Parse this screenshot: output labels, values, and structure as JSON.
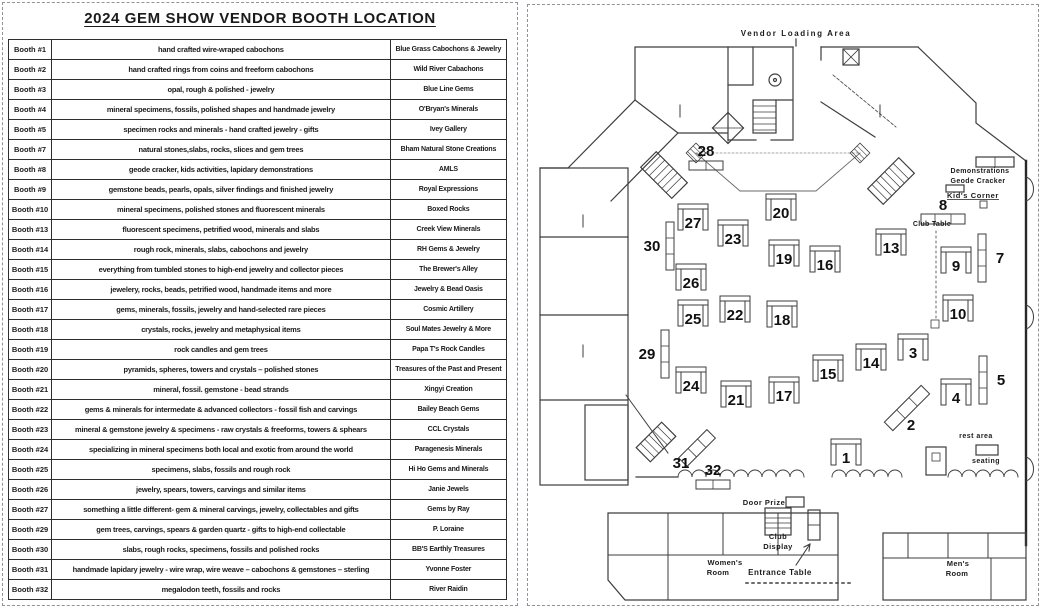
{
  "title": "2024 GEM SHOW VENDOR  BOOTH  LOCATION",
  "table": {
    "rows": [
      {
        "booth": "Booth #1",
        "description": "hand crafted wire-wraped cabochons",
        "vendor": "Blue Grass Cabochons & Jewelry"
      },
      {
        "booth": "Booth #2",
        "description": "hand crafted rings from coins and freeform cabochons",
        "vendor": "Wild River Cabachons"
      },
      {
        "booth": "Booth #3",
        "description": "opal, rough & polished - jewelry",
        "vendor": "Blue Line Gems"
      },
      {
        "booth": "Booth #4",
        "description": "mineral specimens, fossils, polished shapes and handmade jewelry",
        "vendor": "O'Bryan's Minerals"
      },
      {
        "booth": "Booth #5",
        "description": "specimen rocks and minerals - hand crafted jewelry  - gifts",
        "vendor": "Ivey Gallery"
      },
      {
        "booth": "Booth #7",
        "description": "natural stones,slabs, rocks, slices and gem trees",
        "vendor": "Bham Natural Stone Creations"
      },
      {
        "booth": "Booth #8",
        "description": "geode cracker, kids activities, lapidary demonstrations",
        "vendor": "AMLS"
      },
      {
        "booth": "Booth #9",
        "description": "gemstone beads, pearls, opals, silver findings and finished jewelry",
        "vendor": "Royal Expressions"
      },
      {
        "booth": "Booth #10",
        "description": "mineral specimens, polished stones and fluorescent minerals",
        "vendor": "Boxed Rocks"
      },
      {
        "booth": "Booth #13",
        "description": "fluorescent specimens, petrified wood, minerals and slabs",
        "vendor": "Creek View Minerals"
      },
      {
        "booth": "Booth #14",
        "description": "rough rock, minerals, slabs, cabochons and jewelry",
        "vendor": "RH Gems & Jewelry"
      },
      {
        "booth": "Booth #15",
        "description": "everything from tumbled stones to high-end jewelry and collector pieces",
        "vendor": "The Brewer's Alley"
      },
      {
        "booth": "Booth #16",
        "description": "jewelery, rocks, beads, petrified wood, handmade items and more",
        "vendor": "Jewelry & Bead Oasis"
      },
      {
        "booth": "Booth #17",
        "description": "gems, minerals, fossils, jewelry and hand-selected rare pieces",
        "vendor": "Cosmic Artillery"
      },
      {
        "booth": "Booth #18",
        "description": "crystals, rocks, jewelry and metaphysical items",
        "vendor": "Soul Mates Jewelry & More"
      },
      {
        "booth": "Booth #19",
        "description": "rock candles and gem trees",
        "vendor": "Papa T's Rock Candles"
      },
      {
        "booth": "Booth #20",
        "description": "pyramids, spheres, towers and crystals – polished stones",
        "vendor": "Treasures of the Past and Present"
      },
      {
        "booth": "Booth #21",
        "description": "mineral, fossil. gemstone -  bead strands",
        "vendor": "Xingyi Creation"
      },
      {
        "booth": "Booth #22",
        "description": "gems & minerals for intermedate & advanced collectors - fossil fish and carvings",
        "vendor": "Bailey Beach Gems"
      },
      {
        "booth": "Booth #23",
        "description": "mineral & gemstone jewelry & specimens - raw crystals & freeforms, towers & sphears",
        "vendor": "CCL Crystals"
      },
      {
        "booth": "Booth #24",
        "description": "specializing in mineral specimens both local and exotic  from around the world",
        "vendor": "Paragenesis Minerals"
      },
      {
        "booth": "Booth #25",
        "description": "specimens, slabs, fossils and rough rock",
        "vendor": "Hi Ho Gems and Minerals"
      },
      {
        "booth": "Booth #26",
        "description": "jewelry, spears, towers, carvings and similar items",
        "vendor": "Janie Jewels"
      },
      {
        "booth": "Booth #27",
        "description": "something a little different- gem & mineral carvings, jewelry, collectables and gifts",
        "vendor": "Gems by Ray"
      },
      {
        "booth": "Booth #29",
        "description": "gem trees, carvings, spears & garden quartz - gifts to high-end collectable",
        "vendor": "P. Loraine"
      },
      {
        "booth": "Booth #30",
        "description": "slabs, rough rocks, specimens, fossils and polished rocks",
        "vendor": "BB'S Earthly Treasures"
      },
      {
        "booth": "Booth #31",
        "description": "handmade lapidary jewelry - wire wrap, wire weave – cabochons & gemstones – sterling",
        "vendor": "Yvonne Foster"
      },
      {
        "booth": "Booth #32",
        "description": "megalodon teeth, fossils and rocks",
        "vendor": "River Raidin"
      }
    ]
  },
  "map": {
    "booths": [
      {
        "n": "28",
        "x": 178,
        "y": 149,
        "shape": "h"
      },
      {
        "n": "30",
        "x": 124,
        "y": 241,
        "shape": "v"
      },
      {
        "n": "29",
        "x": 119,
        "y": 349,
        "shape": "v"
      },
      {
        "n": "27",
        "x": 165,
        "y": 217,
        "shape": "u"
      },
      {
        "n": "26",
        "x": 163,
        "y": 277,
        "shape": "u"
      },
      {
        "n": "25",
        "x": 165,
        "y": 313,
        "shape": "u"
      },
      {
        "n": "24",
        "x": 163,
        "y": 380,
        "shape": "u"
      },
      {
        "n": "23",
        "x": 205,
        "y": 233,
        "shape": "u"
      },
      {
        "n": "22",
        "x": 207,
        "y": 309,
        "shape": "u"
      },
      {
        "n": "21",
        "x": 208,
        "y": 394,
        "shape": "u"
      },
      {
        "n": "20",
        "x": 253,
        "y": 207,
        "shape": "u"
      },
      {
        "n": "19",
        "x": 256,
        "y": 253,
        "shape": "u"
      },
      {
        "n": "18",
        "x": 254,
        "y": 314,
        "shape": "u"
      },
      {
        "n": "17",
        "x": 256,
        "y": 390,
        "shape": "u"
      },
      {
        "n": "16",
        "x": 297,
        "y": 259,
        "shape": "u"
      },
      {
        "n": "15",
        "x": 300,
        "y": 368,
        "shape": "u"
      },
      {
        "n": "14",
        "x": 343,
        "y": 357,
        "shape": "u"
      },
      {
        "n": "13",
        "x": 363,
        "y": 242,
        "shape": "u"
      },
      {
        "n": "9",
        "x": 428,
        "y": 260,
        "shape": "u"
      },
      {
        "n": "10",
        "x": 430,
        "y": 308,
        "shape": "u"
      },
      {
        "n": "7",
        "x": 472,
        "y": 253,
        "shape": "vl"
      },
      {
        "n": "5",
        "x": 473,
        "y": 375,
        "shape": "vl"
      },
      {
        "n": "3",
        "x": 385,
        "y": 347,
        "shape": "u"
      },
      {
        "n": "4",
        "x": 428,
        "y": 392,
        "shape": "u"
      },
      {
        "n": "2",
        "x": 383,
        "y": 421,
        "shape": "d2"
      },
      {
        "n": "1",
        "x": 318,
        "y": 452,
        "shape": "u"
      },
      {
        "n": "31",
        "x": 153,
        "y": 459,
        "shape": "d31"
      },
      {
        "n": "32",
        "x": 185,
        "y": 468,
        "shape": "h"
      },
      {
        "n": "8",
        "x": 415,
        "y": 203,
        "shape": "h8"
      }
    ],
    "labels": [
      {
        "id": "vendor-loading-area",
        "text": "Vendor Loading Area",
        "x": 268,
        "y": 31,
        "size": 8,
        "spacing": 1.6,
        "weight": "bold"
      },
      {
        "id": "demonstrations",
        "text": "Demonstrations",
        "x": 452,
        "y": 168,
        "size": 7,
        "spacing": 0.4,
        "weight": "bold"
      },
      {
        "id": "geode-cracker",
        "text": "Geode Cracker",
        "x": 450,
        "y": 178,
        "size": 7,
        "spacing": 0.4,
        "weight": "bold"
      },
      {
        "id": "kids-corner",
        "text": "Kid's Corner",
        "x": 445,
        "y": 193,
        "size": 7.5,
        "spacing": 0.6,
        "weight": "bold",
        "underline": true
      },
      {
        "id": "club-table",
        "text": "Club Table",
        "x": 404,
        "y": 221,
        "size": 7,
        "spacing": 0.3,
        "weight": "bold"
      },
      {
        "id": "door-prize",
        "text": "Door Prize",
        "x": 236,
        "y": 500,
        "size": 7.5,
        "spacing": 0.5,
        "weight": "bold"
      },
      {
        "id": "club-display-line1",
        "text": "Club",
        "x": 250,
        "y": 534,
        "size": 7.5,
        "spacing": 0.4,
        "weight": "bold"
      },
      {
        "id": "club-display-line2",
        "text": "Display",
        "x": 250,
        "y": 544,
        "size": 7.5,
        "spacing": 0.4,
        "weight": "bold"
      },
      {
        "id": "womens-room-line1",
        "text": "Women's",
        "x": 197,
        "y": 560,
        "size": 7.5,
        "spacing": 0.3,
        "weight": "bold"
      },
      {
        "id": "womens-room-line2",
        "text": "Room",
        "x": 190,
        "y": 570,
        "size": 7.5,
        "spacing": 0.3,
        "weight": "bold"
      },
      {
        "id": "mens-room-line1",
        "text": "Men's",
        "x": 430,
        "y": 561,
        "size": 7.5,
        "spacing": 0.3,
        "weight": "bold"
      },
      {
        "id": "mens-room-line2",
        "text": "Room",
        "x": 429,
        "y": 571,
        "size": 7.5,
        "spacing": 0.3,
        "weight": "bold"
      },
      {
        "id": "entrance-table",
        "text": "Entrance Table",
        "x": 252,
        "y": 570,
        "size": 8,
        "spacing": 0.5,
        "weight": "bold"
      },
      {
        "id": "rest-area",
        "text": "rest area",
        "x": 448,
        "y": 433,
        "size": 7,
        "spacing": 0.5,
        "weight": "bold"
      },
      {
        "id": "seating",
        "text": "seating",
        "x": 458,
        "y": 458,
        "size": 7,
        "spacing": 0.5,
        "weight": "bold"
      }
    ]
  },
  "colors": {
    "ink": "#1b1b1b",
    "wall": "#3d3d3d",
    "wall_dark": "#282828",
    "dash_border": "#8f949b"
  }
}
